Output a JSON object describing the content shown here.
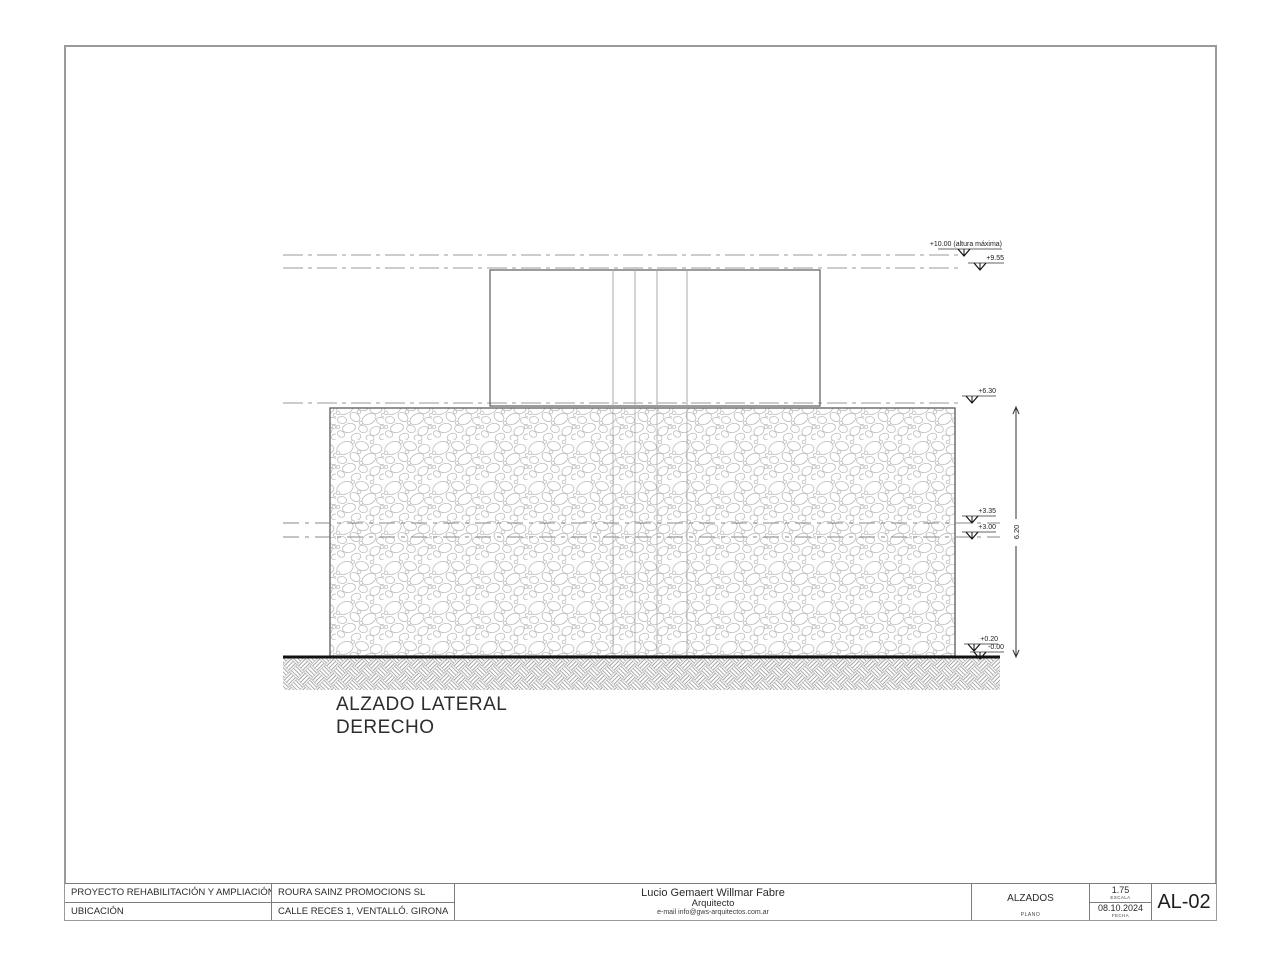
{
  "colors": {
    "sheet_border": "#9a9a9a",
    "drawing_line": "#555555",
    "ground_line": "#111111",
    "hatch_stone": "#b4b4b4",
    "hatch_ground": "#8f8f8f"
  },
  "drawing": {
    "title_line1": "ALZADO LATERAL",
    "title_line2": "DERECHO",
    "dimension_label": "6.20",
    "levels": [
      {
        "label": "+10.00 (altura máxima)"
      },
      {
        "label": "+9.55"
      },
      {
        "label": "+6.30"
      },
      {
        "label": "+3.35"
      },
      {
        "label": "+3.00"
      },
      {
        "label": "+0.20"
      },
      {
        "label": "-0.00"
      }
    ]
  },
  "title_block": {
    "project_label": "PROYECTO REHABILITACIÓN Y AMPLIACIÓN",
    "client": "ROURA SAINZ PROMOCIONS SL",
    "location_label": "UBICACIÓN",
    "address": "CALLE RECES 1, VENTALLÓ. GIRONA",
    "architect_name": "Lucio Gemaert Willmar Fabre",
    "architect_title": "Arquitecto",
    "architect_email": "e-mail info@gws-arquitectos.com.ar",
    "plano_value": "ALZADOS",
    "plano_label": "PLANO",
    "escala_value": "1.75",
    "escala_label": "ESCALA",
    "fecha_value": "08.10.2024",
    "fecha_label": "FECHA",
    "sheet_number": "AL-02"
  }
}
